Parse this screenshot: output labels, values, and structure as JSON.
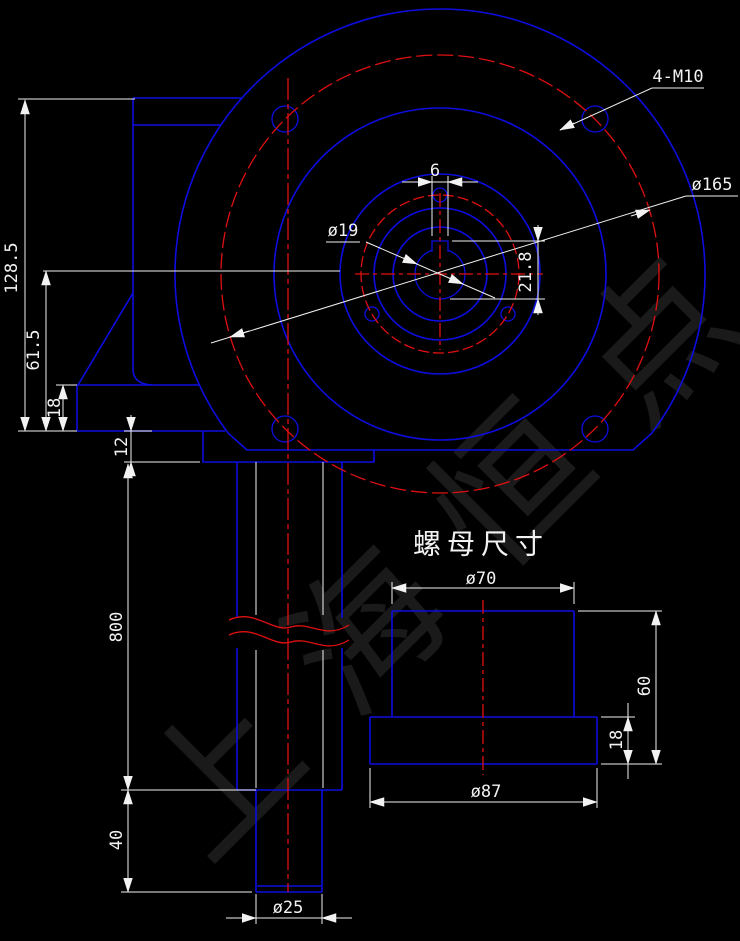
{
  "colors": {
    "background": "#000000",
    "object_lines": "#0d0de0",
    "center_lines": "#e01010",
    "dimension_lines": "#f2f2f2",
    "watermark": "#1a1a1a"
  },
  "watermark": {
    "text": "上海恒点"
  },
  "front_view": {
    "labels": {
      "bolt_holes": "4-M10",
      "bolt_circle_diameter": "ø165",
      "input_bore_diameter": "ø19",
      "keyway_width": "6",
      "keyway_height": "21.8",
      "overall_height": "128.5",
      "center_height": "61.5",
      "base_plate_thickness": "18",
      "bottom_flange_thickness": "12",
      "screw_length": "800",
      "screw_end_length": "40",
      "screw_end_diameter": "ø25"
    }
  },
  "nut_view": {
    "title": "螺母尺寸",
    "labels": {
      "outer_diameter": "ø70",
      "total_height": "60",
      "flange_thickness": "18",
      "flange_diameter": "ø87"
    }
  }
}
